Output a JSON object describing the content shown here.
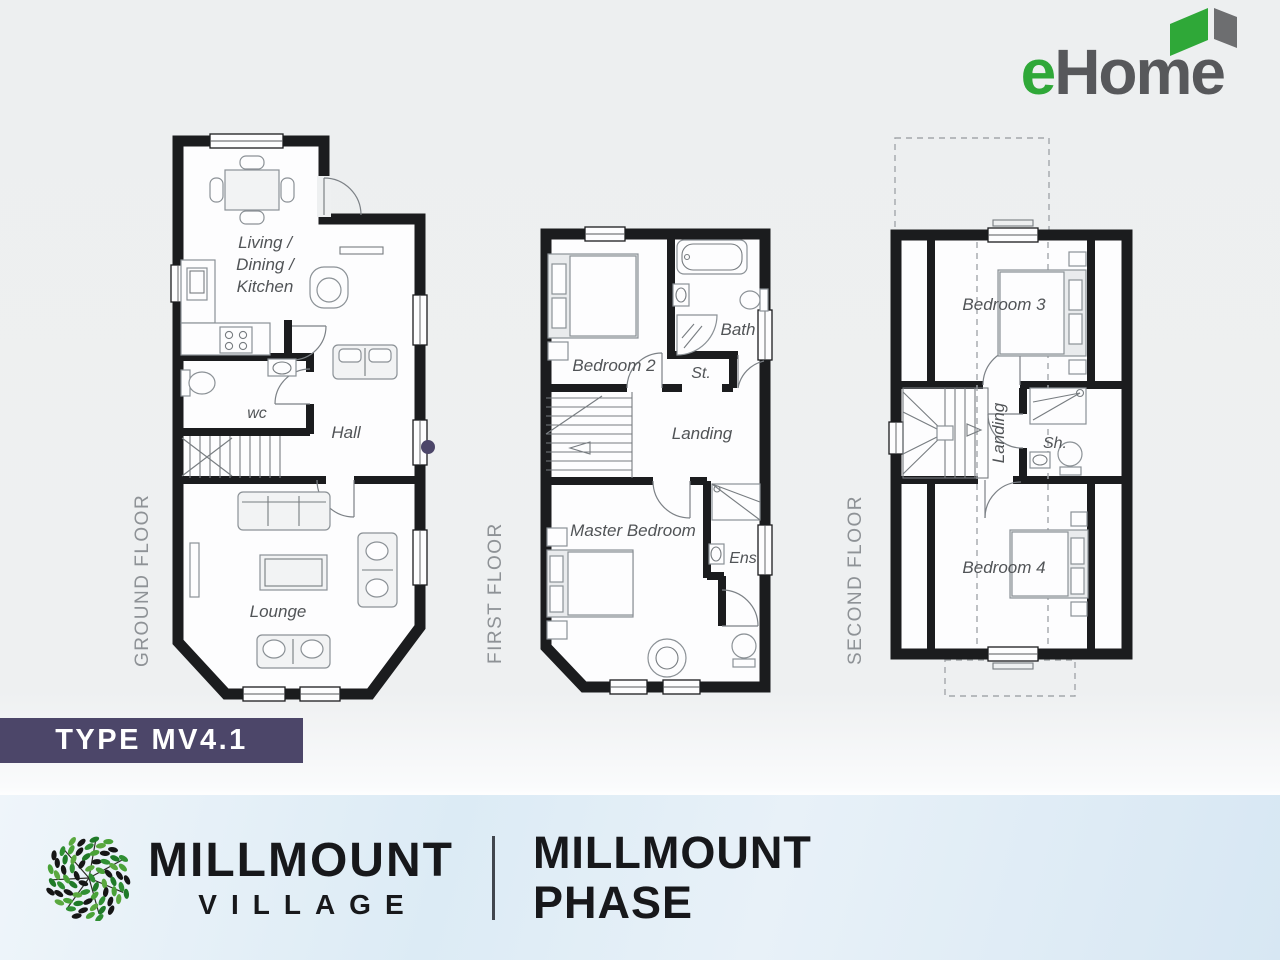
{
  "header": {
    "logo": {
      "e": "e",
      "rest": "Home",
      "icon": "open-book-icon"
    }
  },
  "type_badge": {
    "label": "TYPE MV4.1"
  },
  "floors": {
    "ground": {
      "label": "GROUND FLOOR",
      "rooms": {
        "living_line1": "Living /",
        "living_line2": "Dining /",
        "living_line3": "Kitchen",
        "wc": "wc",
        "hall": "Hall",
        "lounge": "Lounge"
      }
    },
    "first": {
      "label": "FIRST FLOOR",
      "rooms": {
        "bedroom2": "Bedroom 2",
        "bath": "Bath",
        "store": "St.",
        "landing": "Landing",
        "master": "Master Bedroom",
        "ensuite": "Ens"
      }
    },
    "second": {
      "label": "SECOND FLOOR",
      "rooms": {
        "bedroom3": "Bedroom 3",
        "landing": "Landing",
        "shower": "Sh.",
        "bedroom4": "Bedroom 4"
      }
    }
  },
  "footer": {
    "village": {
      "line1": "MILLMOUNT",
      "line2": "VILLAGE"
    },
    "phase": {
      "line1": "MILLMOUNT",
      "line2": "PHASE"
    }
  },
  "colors": {
    "accent_purple": "#4c4669",
    "brand_green": "#2fa838",
    "brand_gray": "#57585b",
    "wall_black": "#1b1c1e"
  }
}
